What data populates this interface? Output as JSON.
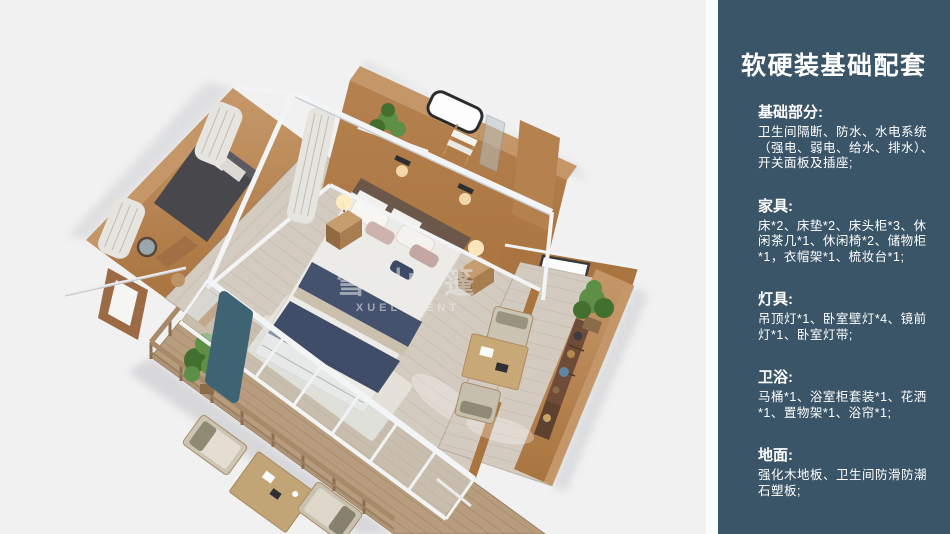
{
  "page": {
    "background": "#f1f1f2"
  },
  "illustration": {
    "description": "isometric 3d cutaway render of tent-house suite with bedroom, bathroom, lounge wing and wooden deck",
    "watermark_line1": "雪利帐篷",
    "watermark_line2": "XUELI TENT",
    "colors": {
      "wall": "#b5814f",
      "wall_shade": "#a9743f",
      "wall_edge": "#c59768",
      "floor": "#d3cbbf",
      "deck": "#b79d7e",
      "frame": "#f2f4f5",
      "bedding": "#edebe7",
      "runner": "#45526e",
      "teal": "#3e6372",
      "curtain": "#e6e4df",
      "plant": "#5d8f47",
      "plant_dark": "#44702f",
      "daybed": "#47474c"
    }
  },
  "sidebar": {
    "background": "#3a5468",
    "text_color": "#ffffff",
    "title": "软硬装基础配套",
    "sections": [
      {
        "heading": "基础部分:",
        "body": "卫生间隔断、防水、水电系统（强电、弱电、给水、排水）、开关面板及插座;"
      },
      {
        "heading": "家具:",
        "body": "床*2、床垫*2、床头柜*3、休闲茶几*1、休闲椅*2、储物柜*1，衣帽架*1、梳妆台*1;"
      },
      {
        "heading": "灯具:",
        "body": "吊顶灯*1、卧室壁灯*4、镜前灯*1、卧室灯带;"
      },
      {
        "heading": "卫浴:",
        "body": "马桶*1、浴室柜套装*1、花洒*1、置物架*1、浴帘*1;"
      },
      {
        "heading": "地面:",
        "body": "强化木地板、卫生间防滑防潮石塑板;"
      }
    ]
  }
}
